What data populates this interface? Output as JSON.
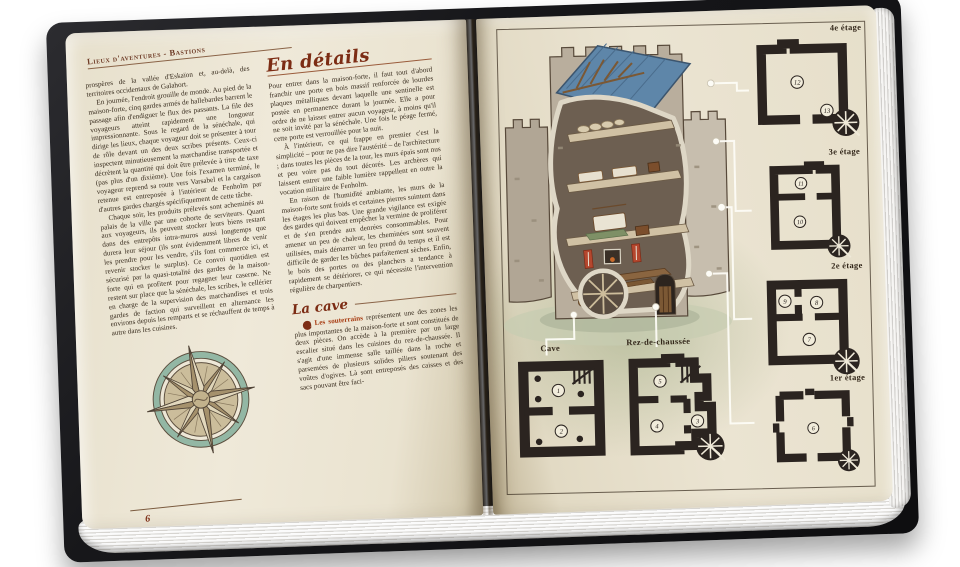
{
  "book": {
    "left_page": {
      "running_header": "Lieux d'aventures - Bastions",
      "page_number": "6",
      "column1": {
        "p1": "prospères de la vallée d'Eskaïon et, au-delà, des territoires occidentaux de Galahort.",
        "p2": "En journée, l'endroit grouille de monde. Au pied de la maison-forte, cinq gardes armés de hallebardes barrent le passage afin d'endiguer le flux des passants. La file des voyageurs atteint rapidement une longueur impressionnante. Sous le regard de la sénéchale, qui dirige les lieux, chaque voyageur doit se présenter à tour de rôle devant un des deux scribes présents. Ceux-ci inspectent minutieusement la marchandise transportée et décrètent la quantité qui doit être prélevée à titre de taxe (pas plus d'un dixième). Une fois l'examen terminé, le voyageur reprend sa route vers Varsabel et la cargaison retenue est entreposée à l'intérieur de Fenholm par d'autres gardes chargés spécifiquement de cette tâche.",
        "p3": "Chaque soir, les produits prélevés sont acheminés au palais de la ville par une cohorte de serviteurs. Quant aux voyageurs, ils peuvent stocker leurs biens restant dans des entrepôts intra-muros aussi longtemps que durera leur séjour (ils sont évidemment libres de venir les prendre pour les vendre, s'ils font commerce ici, et revenir stocker le surplus). Ce convoi quotidien est sécurisé par la quasi-totalité des gardes de la maison-forte qui en profitent pour regagner leur caserne. Ne restent sur place que la sénéchale, les scribes, le cellérier en charge de la supervision des marchandises et trois gardes de faction qui surveillent en alternance les environs depuis les remparts et se réchauffent de temps à autre dans les cuisines."
      },
      "column2": {
        "heading": "En détails",
        "p1": "Pour entrer dans la maison-forte, il faut tout d'abord franchir une porte en bois massif renforcée de lourdes plaques métalliques devant laquelle une sentinelle est postée en permanence durant la journée. Elle a pour ordre de ne laisser entrer aucun voyageur, à moins qu'il ne soit invité par la sénéchale. Une fois le péage fermé, cette porte est verrouillée pour la nuit.",
        "p2": "À l'intérieur, ce qui frappe en premier c'est la simplicité – pour ne pas dire l'austérité – de l'architecture ; dans toutes les pièces de la tour, les murs épais sont nus et peu voire pas du tout décorés. Les archères qui laissent entrer une faible lumière rappellent en outre la vocation militaire de Fenholm.",
        "p3": "En raison de l'humidité ambiante, les murs de la maison-forte sont froids et certaines pierres suintent dans les étages les plus bas. Une grande vigilance est exigée des gardes qui doivent empêcher la vermine de proliférer et de s'en prendre aux denrées consommables. Pour amener un peu de chaleur, les cheminées sont souvent utilisées, mais démarrer un feu prend du temps et il est difficile de garder les bûches parfaitement sèches. Enfin, le bois des portes ou des planchers a tendance à rapidement se détériorer, ce qui nécessite l'intervention régulière de charpentiers.",
        "cave_section": {
          "heading": "La cave",
          "marker": "1",
          "lead": "Les souterrains",
          "text": " représentent une des zones les plus importantes de la maison-forte et sont constitués de deux pièces. On accède à la première par un large escalier situé dans les cuisines du rez-de-chaussée. Il s'agit d'une immense salle taillée dans la roche et parsemées de plusieurs solides piliers soutenant des voûtes d'ogives. Là sont entreposés des caisses et des sacs pouvant être faci-"
        }
      }
    },
    "right_page": {
      "plans": [
        {
          "id": "cave",
          "label": "Cave",
          "rooms": [
            "1",
            "2"
          ]
        },
        {
          "id": "rdc",
          "label": "Rez-de-chaussée",
          "rooms": [
            "5",
            "4",
            "3"
          ]
        },
        {
          "id": "e1",
          "label": "1er étage",
          "rooms": [
            "6"
          ]
        },
        {
          "id": "e2",
          "label": "2e étage",
          "rooms": [
            "9",
            "8",
            "7"
          ]
        },
        {
          "id": "e3",
          "label": "3e étage",
          "rooms": [
            "11",
            "10"
          ]
        },
        {
          "id": "e4",
          "label": "4e étage",
          "rooms": [
            "12",
            "13"
          ]
        }
      ]
    },
    "colors": {
      "parchment": "#ebe4d1",
      "heading_red": "#7c2c14",
      "lead_red": "#a83c12",
      "body_text": "#392d1f",
      "plan_wall": "#2b2420",
      "roof_blue": "#5e86a9",
      "compass_teal": "#93b7a4",
      "cover_black": "#161618",
      "grass_green": "#96a378"
    }
  }
}
